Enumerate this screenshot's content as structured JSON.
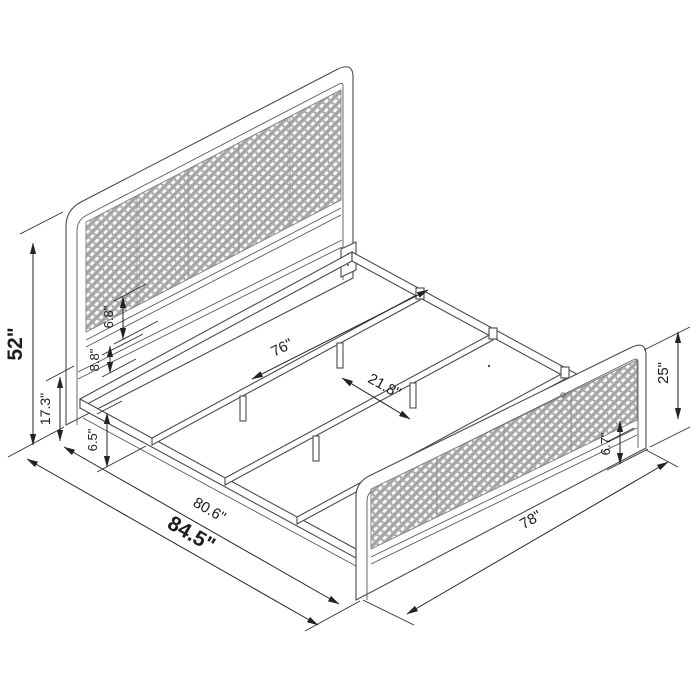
{
  "drawing": {
    "description": "Isometric dimension drawing of a metal platform bed frame with cane webbing headboard and footboard",
    "units": "inches",
    "colors": {
      "background": "#ffffff",
      "structure_line": "#4a4a4a",
      "dimension_line": "#232323",
      "text": "#1c1c1c",
      "cane_mesh_fill": "#b2b2b2",
      "cane_mesh_dot": "#ffffff"
    },
    "labels": {
      "overall_height": "52\"",
      "headboard_leg_height": "17.3\"",
      "headboard_gap_upper": "6.8\"",
      "headboard_gap_lower": "8.8\"",
      "underframe_clearance": "6.5\"",
      "slat_length": "76\"",
      "slat_spacing": "21.8\"",
      "frame_length": "80.6\"",
      "overall_length": "84.5\"",
      "overall_width": "78\"",
      "footboard_height": "25\"",
      "footboard_gap": "6.7\""
    }
  }
}
